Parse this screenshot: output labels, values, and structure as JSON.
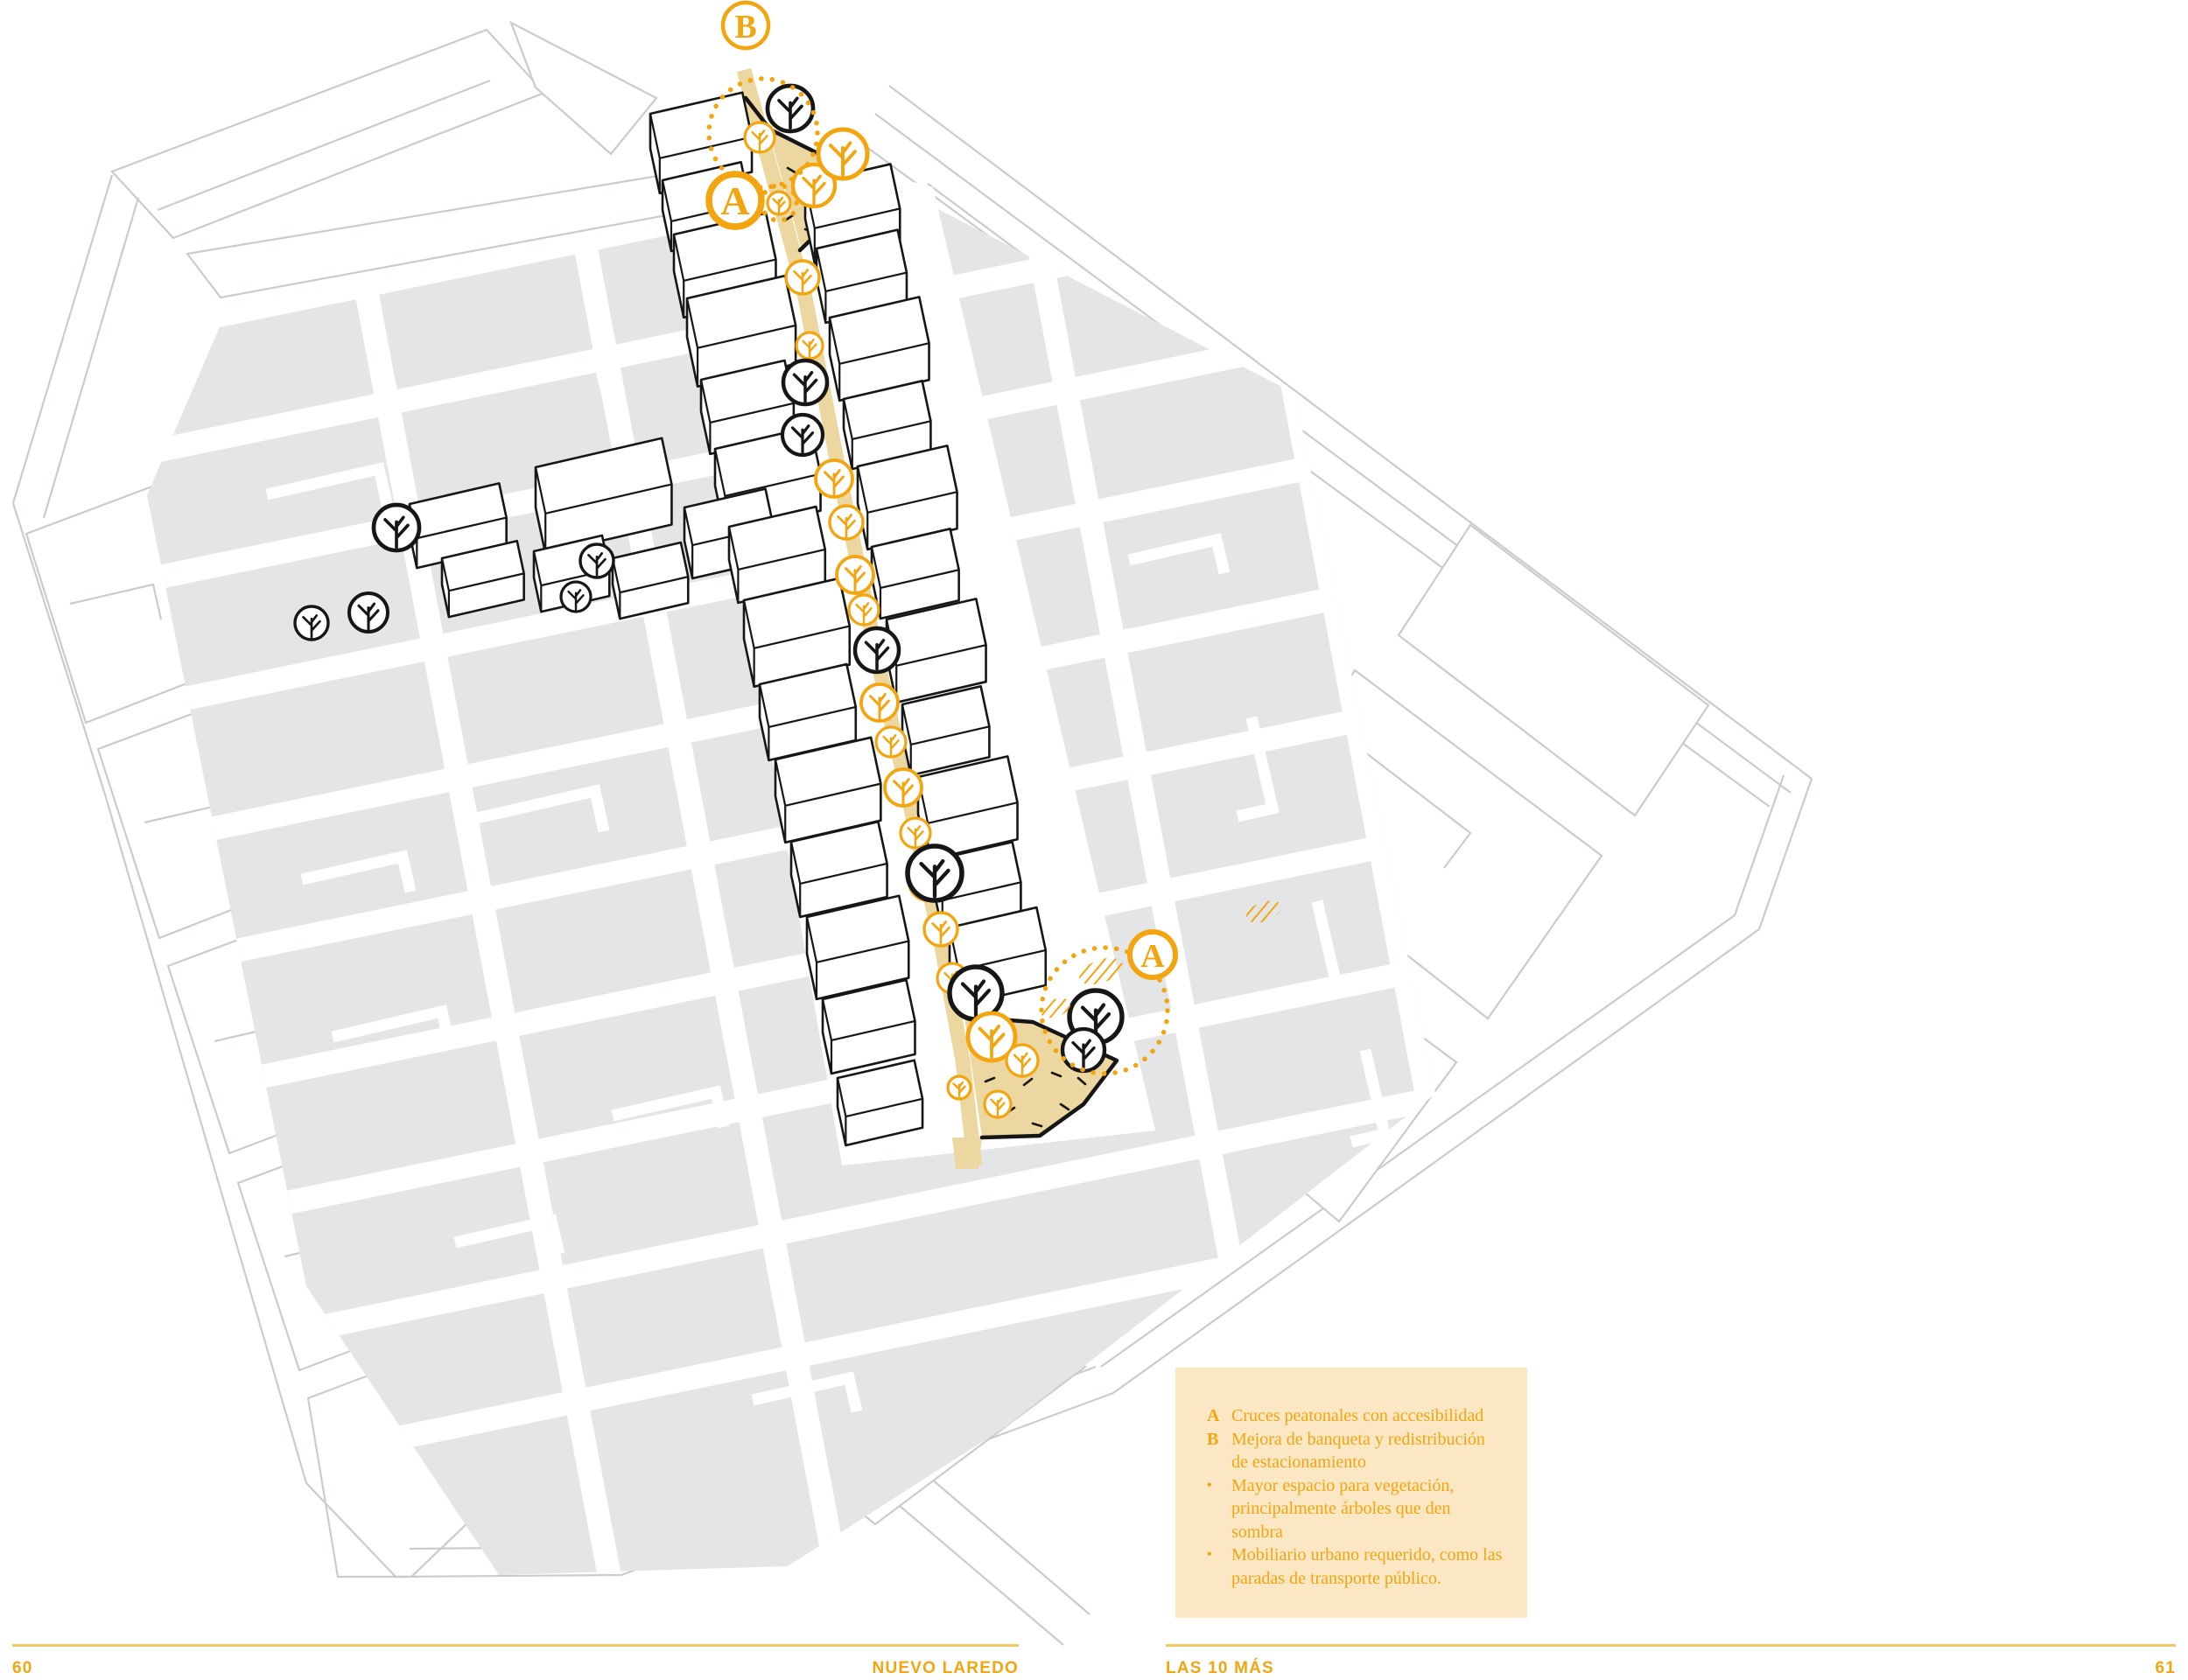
{
  "document": {
    "type": "book-spread",
    "left_page": {
      "number": "60",
      "running_title": "NUEVO LAREDO"
    },
    "right_page": {
      "number": "61",
      "running_title": "LAS 10 MÁS"
    }
  },
  "map": {
    "markers": [
      {
        "id": "marker-b-top",
        "label": "B"
      },
      {
        "id": "marker-a-top",
        "label": "A"
      },
      {
        "id": "marker-a-bottom",
        "label": "A"
      }
    ],
    "icons": [
      "proposed-tree-icon (orange circle with trunk)",
      "existing-tree-icon (black circle with trunk)",
      "crosswalk-hatch-icon (orange striped ellipse)",
      "intervention-area-icon (orange dotted circle)"
    ]
  },
  "legend": {
    "items": [
      {
        "label": "A",
        "text": "Cruces peatonales con accesibilidad"
      },
      {
        "label": "B",
        "text": "Mejora de banqueta y redistribución de estacionamiento"
      },
      {
        "label": "•",
        "text": "Mayor espacio para vegetación, principalmente árboles que den sombra"
      },
      {
        "label": "•",
        "text": "Mobiliario urbano requerido, como las paradas de transporte público."
      }
    ]
  },
  "colors": {
    "accent": "#F2A50F",
    "accent_soft": "#F6C767",
    "corridor_tan": "#EDD7A0",
    "legend_background": "#FBE7C4",
    "block_gray": "#E4E5E7",
    "outline_gray": "#C9CBCE",
    "building_ink": "#161616"
  }
}
